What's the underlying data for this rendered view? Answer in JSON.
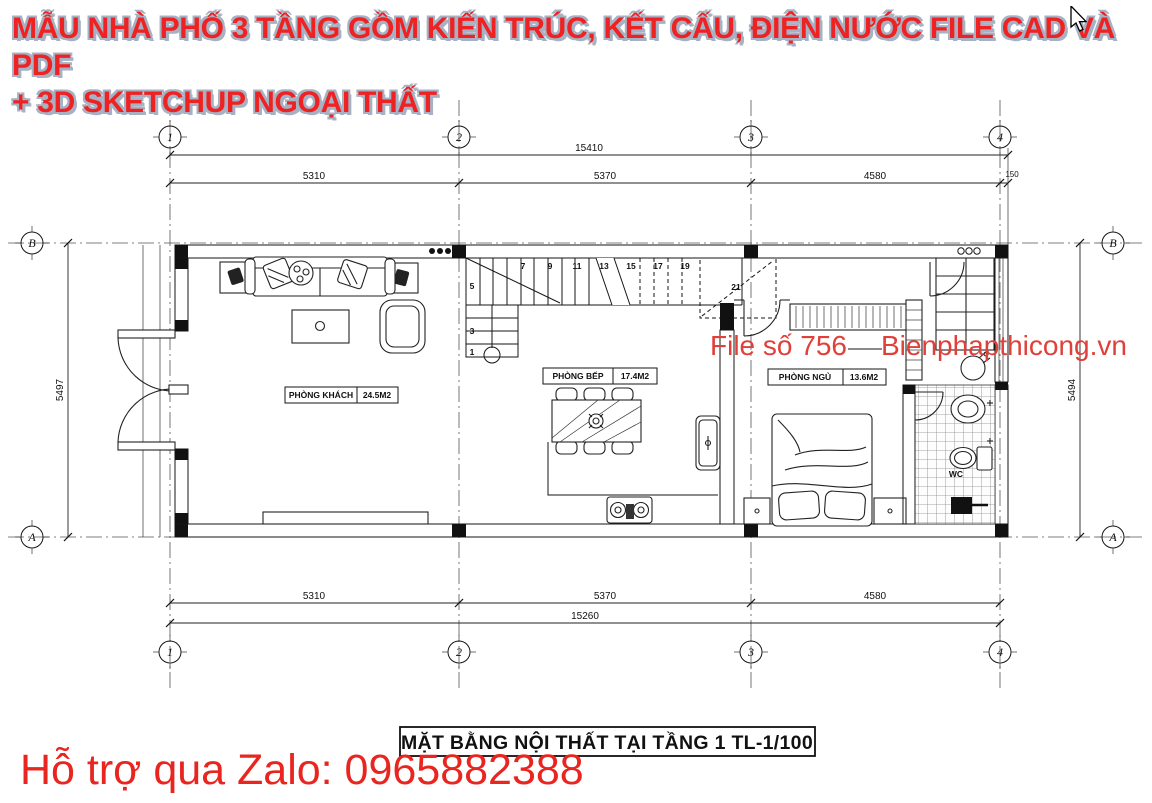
{
  "header": {
    "title_line1": "MẪU NHÀ PHỐ 3 TẦNG GỒM KIẾN TRÚC, KẾT CẤU, ĐIỆN NƯỚC FILE CAD VÀ PDF",
    "title_line2": "+ 3D SKETCHUP NGOẠI THẤT"
  },
  "watermark": {
    "file_no": "File số 756",
    "website": "Bienphapthicong.vn"
  },
  "support": {
    "zalo": "Hỗ trợ qua Zalo: 0965882388"
  },
  "drawing": {
    "caption": "MẶT BẰNG NỘI THẤT TẠI TẦNG 1 TL-1/100",
    "grid_cols": [
      "1",
      "2",
      "3",
      "4"
    ],
    "grid_row_top": "B",
    "grid_row_bottom": "A",
    "dims": {
      "top_total": "15410",
      "top_seg1": "5310",
      "top_seg2": "5370",
      "top_seg3": "4580",
      "top_seg4": "150",
      "bottom_seg1": "5310",
      "bottom_seg2": "5370",
      "bottom_seg3": "4580",
      "bottom_total": "15260",
      "left_total": "5497",
      "right_total": "5494"
    },
    "rooms": [
      {
        "name": "PHÒNG KHÁCH",
        "area": "24.5M2"
      },
      {
        "name": "PHÒNG BẾP",
        "area": "17.4M2"
      },
      {
        "name": "PHÒNG NGỦ",
        "area": "13.6M2"
      }
    ],
    "wc_label": "WC",
    "stair_numbers": [
      "1",
      "3",
      "5",
      "7",
      "9",
      "11",
      "13",
      "15",
      "17",
      "19",
      "21"
    ]
  },
  "colors": {
    "title_red": "#ee2222",
    "title_outline": "#a6b2c3",
    "watermark_red": "#e0403a",
    "support_red": "#e8251f"
  }
}
